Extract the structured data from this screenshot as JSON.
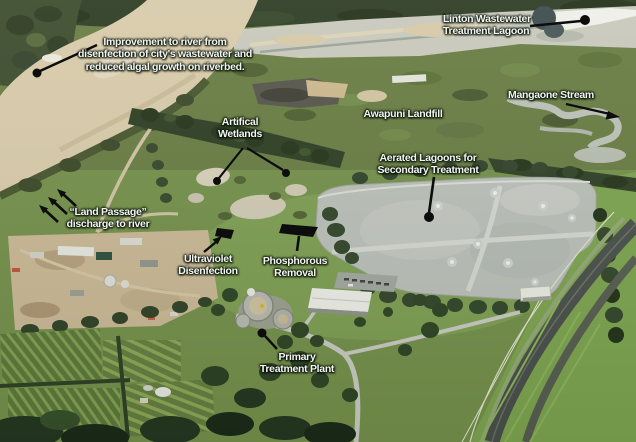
{
  "figure": {
    "labels": {
      "improvement": "Improvement to river from\ndisenfection of city's wastewater and\nreduced algal growth on riverbed.",
      "linton": "Linton Wastewater\nTreatment Lagoon",
      "mangaone": "Mangaone Stream",
      "awapuni": "Awapuni Landfill",
      "wetlands": "Artifical\nWetlands",
      "aerated": "Aerated Lagoons for\nSecondary Treatment",
      "land_passage": "“Land Passage”\ndischarge to river",
      "uv": "Ultraviolet\nDisenfection",
      "phosphorous": "Phosphorous\nRemoval",
      "primary": "Primary\nTreatment Plant"
    },
    "colors": {
      "label_text": "#f3f5f1",
      "leader_line": "#0d0d0d",
      "river_water": "#d8cbaa",
      "lagoon_water": "#babfb8",
      "field_green": "#74904b",
      "forest_green": "#2c3b22",
      "linton_lagoon": "#eef0e8"
    }
  }
}
